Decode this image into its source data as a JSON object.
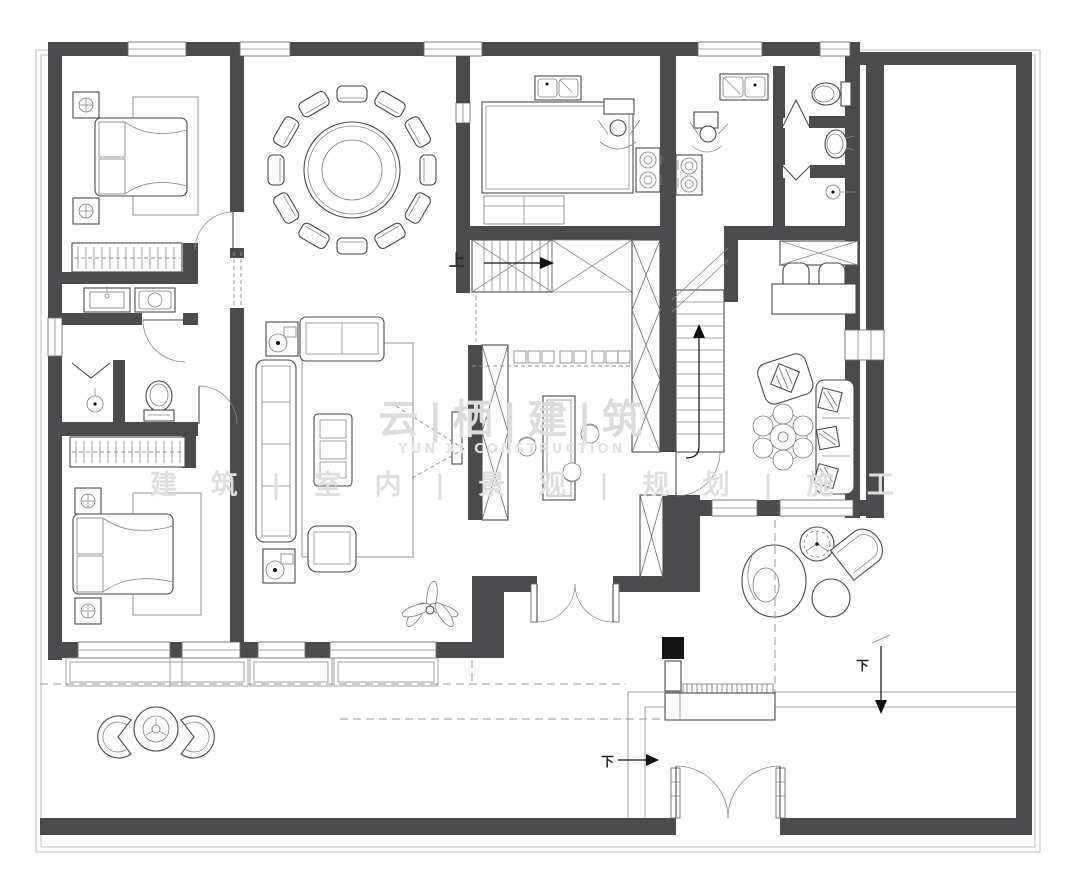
{
  "watermark": {
    "title_cn": "云|栖|建|筑",
    "title_en": "YUN XI CONSTRUCTION",
    "tagline_cn": "建 筑 | 室 内 | 景 观 | 规 划 | 施 工"
  },
  "annotations": {
    "stairs_up_label": "上",
    "stairs_down_label_left": "下",
    "stairs_down_label_right": "下"
  },
  "palette": {
    "wall_fill": "#4b4b4d",
    "drawing_line": "#4a4a4a",
    "thin_line": "#8a8a8a",
    "boundary_line": "#b9b9b9",
    "dashed_line": "#9a9a9a",
    "watermark_text": "#dcdcdc",
    "background": "#ffffff",
    "column_fill": "#151515"
  },
  "icons": [
    "double-bed-icon",
    "pillow-icon",
    "nightstand-icon",
    "table-lamp-icon",
    "wardrobe-hanger-icon",
    "vanity-sink-icon",
    "washing-machine-icon",
    "shower-head-icon",
    "folding-door-icon",
    "toilet-icon",
    "round-dining-table-icon",
    "lazy-susan-icon",
    "dining-chair-icon",
    "kitchen-counter-icon",
    "double-sink-icon",
    "gas-stove-icon",
    "cook-figure-icon",
    "wash-basin-icon",
    "staircase-icon",
    "direction-arrow-icon",
    "storage-cabinet-icon",
    "bar-island-icon",
    "bar-stool-icon",
    "tv-icon",
    "fabric-sofa-icon",
    "loveseat-icon",
    "armchair-icon",
    "coffee-table-icon",
    "speaker-icon",
    "area-rug-icon",
    "writing-desk-icon",
    "office-chair-icon",
    "sideboard-icon",
    "flower-side-table-icon",
    "throw-pillow-icon",
    "egg-chair-icon",
    "spoke-table-icon",
    "ottoman-icon",
    "curved-lounge-chair-icon",
    "patio-table-icon",
    "patio-chair-icon",
    "plant-icon",
    "planter-box-icon",
    "entry-steps-icon",
    "double-swing-door-icon",
    "single-swing-door-icon",
    "window-icon",
    "bay-window-icon"
  ]
}
